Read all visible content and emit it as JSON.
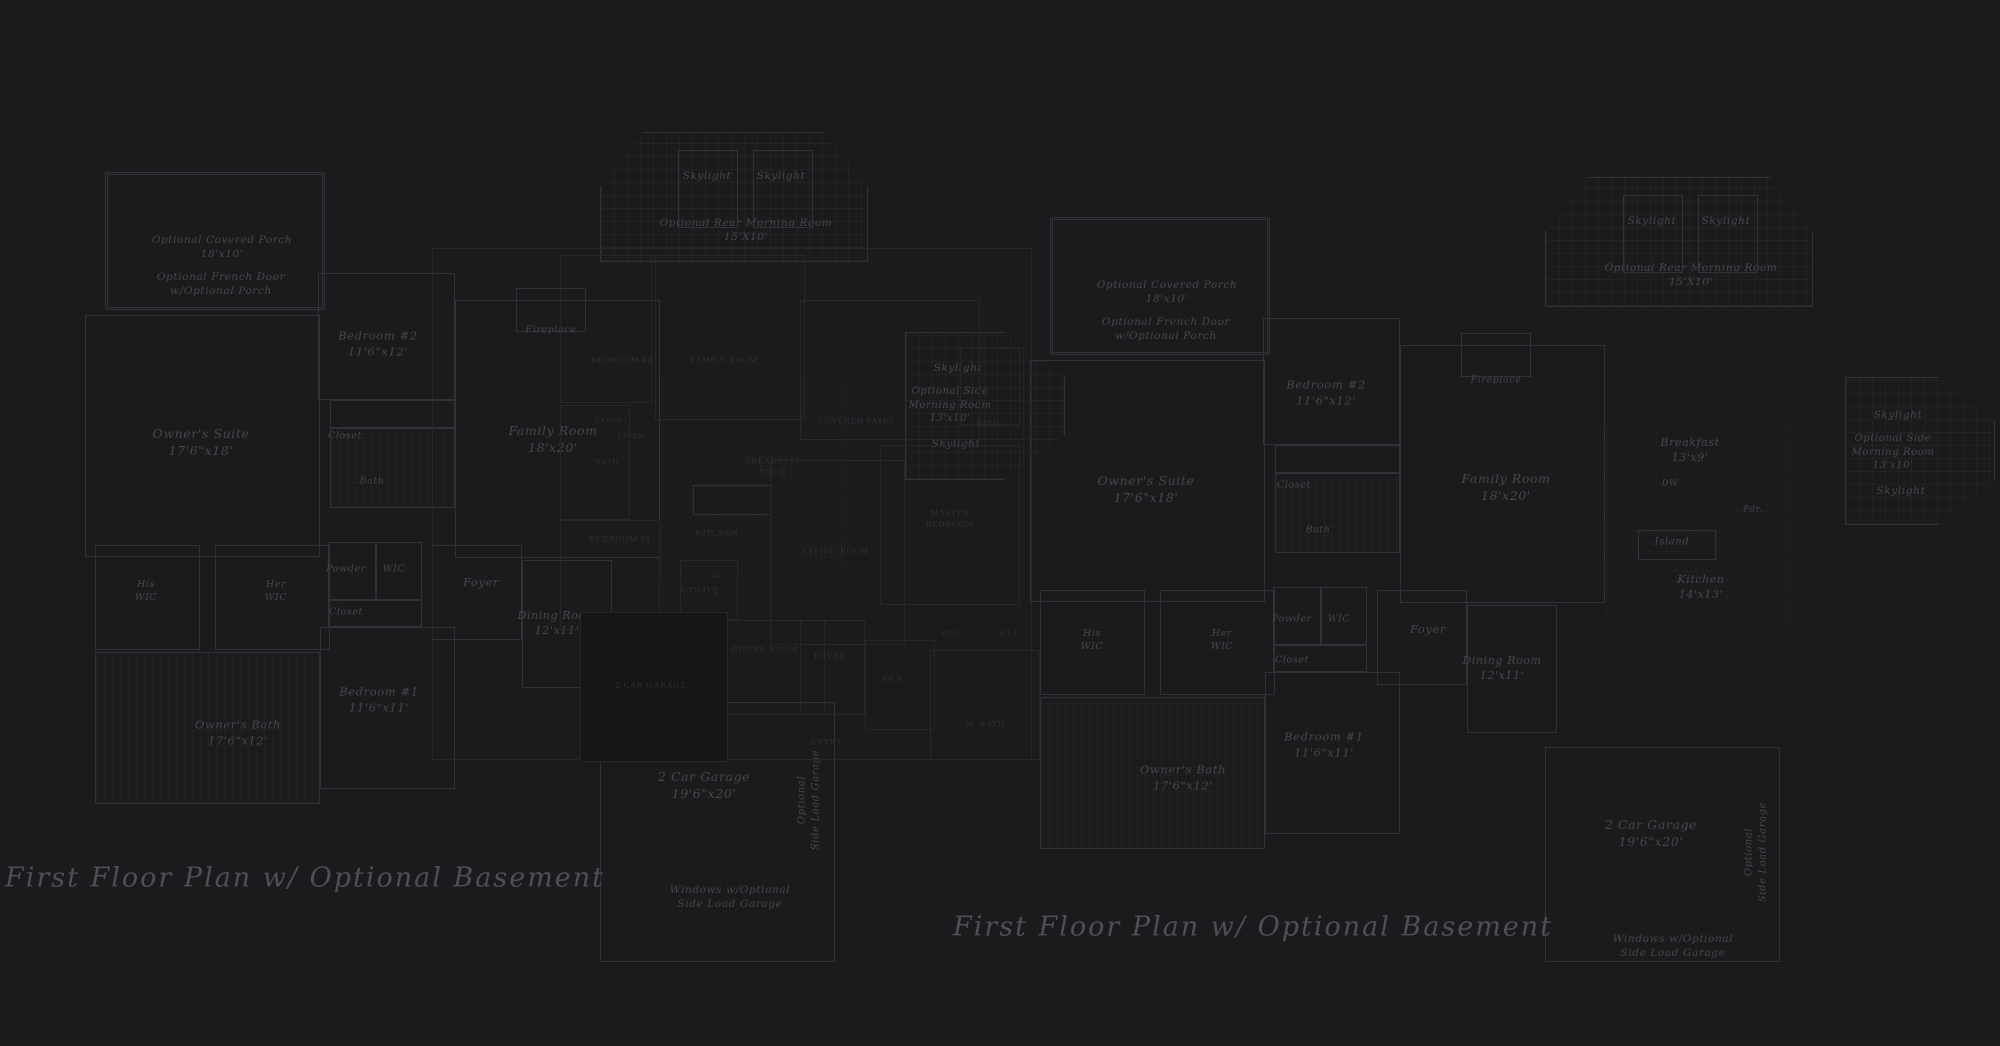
{
  "canvas": {
    "width": 2000,
    "height": 1046,
    "background": "#1b1b1d"
  },
  "colors": {
    "script_line": "#323236",
    "script_text": "#47474c",
    "caps_line": "#27272a",
    "caps_text": "#313135",
    "title_text": "#4f4f55"
  },
  "titles": [
    {
      "text": "First Floor Plan  w/ Optional Basement",
      "cx": 305,
      "cy": 878
    },
    {
      "text": "First Floor Plan  w/ Optional Basement",
      "cx": 1253,
      "cy": 927
    }
  ],
  "plans": {
    "left": {
      "style": "script",
      "rooms": [
        {
          "id": "covered-porch",
          "label": "Optional Covered Porch\n18'x10'",
          "cx": 222,
          "cy": 247,
          "fs": 10.5,
          "box": [
            105,
            172,
            220,
            138
          ],
          "kind": "porch"
        },
        {
          "id": "french-door-note",
          "label": "Optional French Door\nw/Optional Porch",
          "cx": 221,
          "cy": 284,
          "fs": 10.5
        },
        {
          "id": "bedroom-2",
          "label": "Bedroom #2\n11'6\"x12'",
          "cx": 378,
          "cy": 344,
          "fs": 11.5,
          "box": [
            318,
            273,
            137,
            127
          ]
        },
        {
          "id": "owners-suite",
          "label": "Owner's Suite\n17'6\"x18'",
          "cx": 201,
          "cy": 443,
          "fs": 12.5,
          "box": [
            85,
            315,
            235,
            242
          ]
        },
        {
          "id": "closet-1",
          "label": "Closet",
          "cx": 345,
          "cy": 437,
          "fs": 9.5,
          "box": [
            330,
            400,
            125,
            28
          ]
        },
        {
          "id": "bath",
          "label": "Bath",
          "cx": 372,
          "cy": 482,
          "fs": 9.5,
          "box": [
            330,
            428,
            125,
            80
          ],
          "kind": "tile"
        },
        {
          "id": "his-wic",
          "label": "His\nWIC",
          "cx": 146,
          "cy": 592,
          "fs": 9.5,
          "box": [
            95,
            545,
            105,
            105
          ]
        },
        {
          "id": "her-wic",
          "label": "Her\nWIC",
          "cx": 276,
          "cy": 592,
          "fs": 9.5,
          "box": [
            215,
            545,
            115,
            105
          ]
        },
        {
          "id": "powder",
          "label": "Powder",
          "cx": 346,
          "cy": 570,
          "fs": 9.5,
          "box": [
            328,
            542,
            48,
            58
          ]
        },
        {
          "id": "wic",
          "label": "WIC",
          "cx": 394,
          "cy": 570,
          "fs": 9.5,
          "box": [
            376,
            542,
            46,
            58
          ]
        },
        {
          "id": "closet-2",
          "label": "Closet",
          "cx": 346,
          "cy": 613,
          "fs": 9.5,
          "box": [
            328,
            600,
            94,
            27
          ]
        },
        {
          "id": "bedroom-1",
          "label": "Bedroom #1\n11'6\"x11'",
          "cx": 379,
          "cy": 700,
          "fs": 11.5,
          "box": [
            320,
            627,
            135,
            162
          ]
        },
        {
          "id": "owners-bath",
          "label": "Owner's Bath\n17'6\"x12'",
          "cx": 238,
          "cy": 733,
          "fs": 11.5,
          "box": [
            95,
            652,
            225,
            152
          ],
          "kind": "tile"
        },
        {
          "id": "fireplace",
          "label": "Fireplace",
          "cx": 551,
          "cy": 331,
          "fs": 9.5,
          "box": [
            516,
            288,
            70,
            44
          ]
        },
        {
          "id": "family-room",
          "label": "Family Room\n18'x20'",
          "cx": 553,
          "cy": 440,
          "fs": 12.5,
          "box": [
            455,
            300,
            205,
            258
          ]
        },
        {
          "id": "rear-morning-room",
          "label": "Optional Rear Morning Room\n15'X10'",
          "cx": 746,
          "cy": 230,
          "fs": 10.5,
          "box": [
            600,
            132,
            268,
            130
          ],
          "kind": "grid octtop"
        },
        {
          "id": "skylight-1",
          "label": "Skylight",
          "cx": 707,
          "cy": 176,
          "fs": 10.5,
          "box": [
            678,
            150,
            60,
            78
          ]
        },
        {
          "id": "skylight-2",
          "label": "Skylight",
          "cx": 781,
          "cy": 176,
          "fs": 10.5,
          "box": [
            753,
            150,
            60,
            78
          ]
        },
        {
          "id": "foyer",
          "label": "Foyer",
          "cx": 481,
          "cy": 583,
          "fs": 11.5,
          "box": [
            432,
            545,
            90,
            95
          ]
        },
        {
          "id": "dining-room",
          "label": "Dining Room\n12'x11'",
          "cx": 557,
          "cy": 624,
          "fs": 11,
          "box": [
            522,
            560,
            90,
            128
          ]
        },
        {
          "id": "kitchen-zone",
          "label": "",
          "cx": 0,
          "cy": 0,
          "box": [
            660,
            378,
            185,
            200
          ],
          "kind": "gridfaint"
        },
        {
          "id": "island",
          "label": "",
          "cx": 0,
          "cy": 0,
          "box": [
            693,
            485,
            78,
            30
          ]
        },
        {
          "id": "garage",
          "label": "2 Car Garage\n19'6\"x20'",
          "cx": 704,
          "cy": 786,
          "fs": 12.5,
          "box": [
            600,
            702,
            235,
            260
          ]
        },
        {
          "id": "windows-note",
          "label": "Windows w/Optional\nSide Load Garage",
          "cx": 730,
          "cy": 897,
          "fs": 10.5
        },
        {
          "id": "side-load-note",
          "label": "Optional\nSide Load Garage",
          "cx": 809,
          "cy": 800,
          "fs": 10,
          "rot": true
        },
        {
          "id": "side-skylight-1",
          "label": "Skylight",
          "cx": 958,
          "cy": 368,
          "fs": 10.5
        },
        {
          "id": "side-morning-room",
          "label": "Optional Side\nMorning Room\n13'x10'",
          "cx": 950,
          "cy": 405,
          "fs": 10,
          "box": [
            905,
            332,
            160,
            148
          ],
          "kind": "grid octright"
        },
        {
          "id": "side-skylight-2",
          "label": "Skylight",
          "cx": 956,
          "cy": 444,
          "fs": 10.5
        }
      ]
    },
    "middle": {
      "style": "caps",
      "rooms": [
        {
          "id": "envelope",
          "label": "",
          "cx": 0,
          "cy": 0,
          "box": [
            432,
            248,
            600,
            512
          ]
        },
        {
          "id": "bedroom2",
          "label": "BEDROOM #2",
          "cx": 622,
          "cy": 360,
          "fs": 8.5,
          "box": [
            560,
            255,
            92,
            148
          ]
        },
        {
          "id": "family-room",
          "label": "FAMILY ROOM",
          "cx": 724,
          "cy": 360,
          "fs": 8.5,
          "box": [
            655,
            255,
            150,
            165
          ]
        },
        {
          "id": "closet",
          "label": "CLOSET",
          "cx": 612,
          "cy": 420,
          "fs": 7.5
        },
        {
          "id": "linen",
          "label": "LINEN",
          "cx": 631,
          "cy": 436,
          "fs": 7.5
        },
        {
          "id": "bath-1",
          "label": "BATH",
          "cx": 607,
          "cy": 463,
          "fs": 8,
          "box": [
            560,
            405,
            70,
            115
          ]
        },
        {
          "id": "bedroom3",
          "label": "BEDROOM #3",
          "cx": 620,
          "cy": 539,
          "fs": 8.5,
          "box": [
            560,
            520,
            100,
            110
          ]
        },
        {
          "id": "kitchen",
          "label": "KITCHEN",
          "cx": 717,
          "cy": 533,
          "fs": 8.5
        },
        {
          "id": "breakfast-nook",
          "label": "BREAKFAST\nNOOK",
          "cx": 773,
          "cy": 467,
          "fs": 8.5
        },
        {
          "id": "covered-patio",
          "label": "COVERED PATIO",
          "cx": 856,
          "cy": 421,
          "fs": 8.5,
          "box": [
            800,
            300,
            180,
            140
          ]
        },
        {
          "id": "bath-2",
          "label": "BATH",
          "cx": 988,
          "cy": 424,
          "fs": 8,
          "box": [
            960,
            347,
            60,
            78
          ]
        },
        {
          "id": "master-bedroom",
          "label": "MASTER\nBEDROOM",
          "cx": 950,
          "cy": 519,
          "fs": 8.5,
          "box": [
            880,
            445,
            140,
            160
          ]
        },
        {
          "id": "living-room",
          "label": "LIVING ROOM",
          "cx": 836,
          "cy": 551,
          "fs": 8.5,
          "box": [
            770,
            460,
            135,
            185
          ]
        },
        {
          "id": "utility",
          "label": "UTILITY",
          "cx": 700,
          "cy": 591,
          "fs": 8,
          "box": [
            680,
            560,
            58,
            60
          ]
        },
        {
          "id": "washer",
          "label": "W",
          "cx": 716,
          "cy": 576,
          "fs": 7.5
        },
        {
          "id": "dryer",
          "label": "D",
          "cx": 716,
          "cy": 595,
          "fs": 7.5
        },
        {
          "id": "dining-room",
          "label": "DINING ROOM",
          "cx": 765,
          "cy": 649,
          "fs": 8.5,
          "box": [
            720,
            620,
            105,
            95
          ]
        },
        {
          "id": "foyer",
          "label": "FOYER",
          "cx": 830,
          "cy": 656,
          "fs": 8.5,
          "box": [
            800,
            620,
            65,
            95
          ]
        },
        {
          "id": "entry",
          "label": "ENTRY",
          "cx": 827,
          "cy": 742,
          "fs": 8.5
        },
        {
          "id": "den",
          "label": "DEN",
          "cx": 893,
          "cy": 679,
          "fs": 8.5,
          "box": [
            865,
            640,
            70,
            90
          ]
        },
        {
          "id": "wic-1",
          "label": "W.I.C.",
          "cx": 953,
          "cy": 633,
          "fs": 7.5
        },
        {
          "id": "wic-2",
          "label": "W.I.C.",
          "cx": 1010,
          "cy": 633,
          "fs": 7.5
        },
        {
          "id": "m-bath",
          "label": "M. BATH",
          "cx": 985,
          "cy": 724,
          "fs": 8.5,
          "box": [
            930,
            650,
            110,
            110
          ]
        },
        {
          "id": "garage",
          "label": "2 CAR GARAGE",
          "cx": 651,
          "cy": 685,
          "fs": 8.5,
          "box": [
            580,
            612,
            148,
            150
          ],
          "kind": "fill"
        }
      ]
    },
    "right": {
      "style": "script",
      "rooms": [
        {
          "id": "covered-porch",
          "label": "Optional Covered Porch\n18'x10'",
          "cx": 1167,
          "cy": 292,
          "fs": 10.5,
          "box": [
            1050,
            217,
            220,
            138
          ],
          "kind": "porch"
        },
        {
          "id": "french-door-note",
          "label": "Optional French Door\nw/Optional Porch",
          "cx": 1166,
          "cy": 329,
          "fs": 10.5
        },
        {
          "id": "bedroom-2",
          "label": "Bedroom #2\n11'6\"x12'",
          "cx": 1326,
          "cy": 393,
          "fs": 11.5,
          "box": [
            1263,
            318,
            137,
            127
          ]
        },
        {
          "id": "owners-suite",
          "label": "Owner's Suite\n17'6\"x18'",
          "cx": 1146,
          "cy": 490,
          "fs": 12.5,
          "box": [
            1030,
            360,
            235,
            242
          ]
        },
        {
          "id": "closet-1",
          "label": "Closet",
          "cx": 1294,
          "cy": 486,
          "fs": 9.5,
          "box": [
            1275,
            445,
            125,
            28
          ]
        },
        {
          "id": "bath",
          "label": "Bath",
          "cx": 1318,
          "cy": 531,
          "fs": 9.5,
          "box": [
            1275,
            473,
            125,
            80
          ],
          "kind": "tile"
        },
        {
          "id": "his-wic",
          "label": "His\nWIC",
          "cx": 1092,
          "cy": 641,
          "fs": 9.5,
          "box": [
            1040,
            590,
            105,
            105
          ]
        },
        {
          "id": "her-wic",
          "label": "Her\nWIC",
          "cx": 1222,
          "cy": 641,
          "fs": 9.5,
          "box": [
            1160,
            590,
            115,
            105
          ]
        },
        {
          "id": "powder",
          "label": "Powder",
          "cx": 1292,
          "cy": 620,
          "fs": 9.5,
          "box": [
            1273,
            587,
            48,
            58
          ]
        },
        {
          "id": "wic",
          "label": "WIC",
          "cx": 1339,
          "cy": 620,
          "fs": 9.5,
          "box": [
            1321,
            587,
            46,
            58
          ]
        },
        {
          "id": "closet-2",
          "label": "Closet",
          "cx": 1292,
          "cy": 661,
          "fs": 9.5,
          "box": [
            1273,
            645,
            94,
            27
          ]
        },
        {
          "id": "bedroom-1",
          "label": "Bedroom #1\n11'6\"x11'",
          "cx": 1324,
          "cy": 745,
          "fs": 11.5,
          "box": [
            1265,
            672,
            135,
            162
          ]
        },
        {
          "id": "owners-bath",
          "label": "Owner's Bath\n17'6\"x12'",
          "cx": 1183,
          "cy": 778,
          "fs": 11.5,
          "box": [
            1040,
            697,
            225,
            152
          ],
          "kind": "tile"
        },
        {
          "id": "fireplace",
          "label": "Fireplace",
          "cx": 1496,
          "cy": 381,
          "fs": 9.5,
          "box": [
            1461,
            333,
            70,
            44
          ]
        },
        {
          "id": "family-room",
          "label": "Family Room\n18'x20'",
          "cx": 1506,
          "cy": 488,
          "fs": 12.5,
          "box": [
            1400,
            345,
            205,
            258
          ]
        },
        {
          "id": "rear-morning-room",
          "label": "Optional Rear Morning Room\n15'X10'",
          "cx": 1691,
          "cy": 275,
          "fs": 10.5,
          "box": [
            1545,
            177,
            268,
            130
          ],
          "kind": "grid octtop"
        },
        {
          "id": "skylight-1",
          "label": "Skylight",
          "cx": 1652,
          "cy": 221,
          "fs": 10.5,
          "box": [
            1623,
            195,
            60,
            78
          ]
        },
        {
          "id": "skylight-2",
          "label": "Skylight",
          "cx": 1726,
          "cy": 221,
          "fs": 10.5,
          "box": [
            1698,
            195,
            60,
            78
          ]
        },
        {
          "id": "foyer",
          "label": "Foyer",
          "cx": 1428,
          "cy": 630,
          "fs": 11.5,
          "box": [
            1377,
            590,
            90,
            95
          ]
        },
        {
          "id": "dining-room",
          "label": "Dining Room\n12'x11'",
          "cx": 1502,
          "cy": 669,
          "fs": 11,
          "box": [
            1467,
            605,
            90,
            128
          ]
        },
        {
          "id": "kitchen-zone",
          "label": "",
          "cx": 0,
          "cy": 0,
          "box": [
            1605,
            423,
            185,
            200
          ],
          "kind": "gridfaint"
        },
        {
          "id": "breakfast",
          "label": "Breakfast\n13'x9'",
          "cx": 1690,
          "cy": 451,
          "fs": 11
        },
        {
          "id": "dw",
          "label": "DW",
          "cx": 1670,
          "cy": 484,
          "fs": 8.5
        },
        {
          "id": "island",
          "label": "Island",
          "cx": 1672,
          "cy": 542,
          "fs": 10,
          "box": [
            1638,
            530,
            78,
            30
          ]
        },
        {
          "id": "kitchen",
          "label": "Kitchen\n14'x13'",
          "cx": 1701,
          "cy": 588,
          "fs": 11
        },
        {
          "id": "pdr",
          "label": "Pdr.",
          "cx": 1753,
          "cy": 510,
          "fs": 8.5
        },
        {
          "id": "garage",
          "label": "2 Car Garage\n19'6\"x20'",
          "cx": 1651,
          "cy": 834,
          "fs": 12.5,
          "box": [
            1545,
            747,
            235,
            215
          ]
        },
        {
          "id": "windows-note",
          "label": "Windows w/Optional\nSide Load Garage",
          "cx": 1673,
          "cy": 946,
          "fs": 10.5
        },
        {
          "id": "side-load-note",
          "label": "Optional\nSide Load Garage",
          "cx": 1756,
          "cy": 852,
          "fs": 10,
          "rot": true
        },
        {
          "id": "side-skylight-1",
          "label": "Skylight",
          "cx": 1898,
          "cy": 415,
          "fs": 10.5
        },
        {
          "id": "side-morning-room",
          "label": "Optional Side\nMorning Room\n13'x10'",
          "cx": 1893,
          "cy": 452,
          "fs": 10,
          "box": [
            1845,
            377,
            150,
            148
          ],
          "kind": "grid octright"
        },
        {
          "id": "side-skylight-2",
          "label": "Skylight",
          "cx": 1901,
          "cy": 491,
          "fs": 10.5
        }
      ]
    }
  }
}
